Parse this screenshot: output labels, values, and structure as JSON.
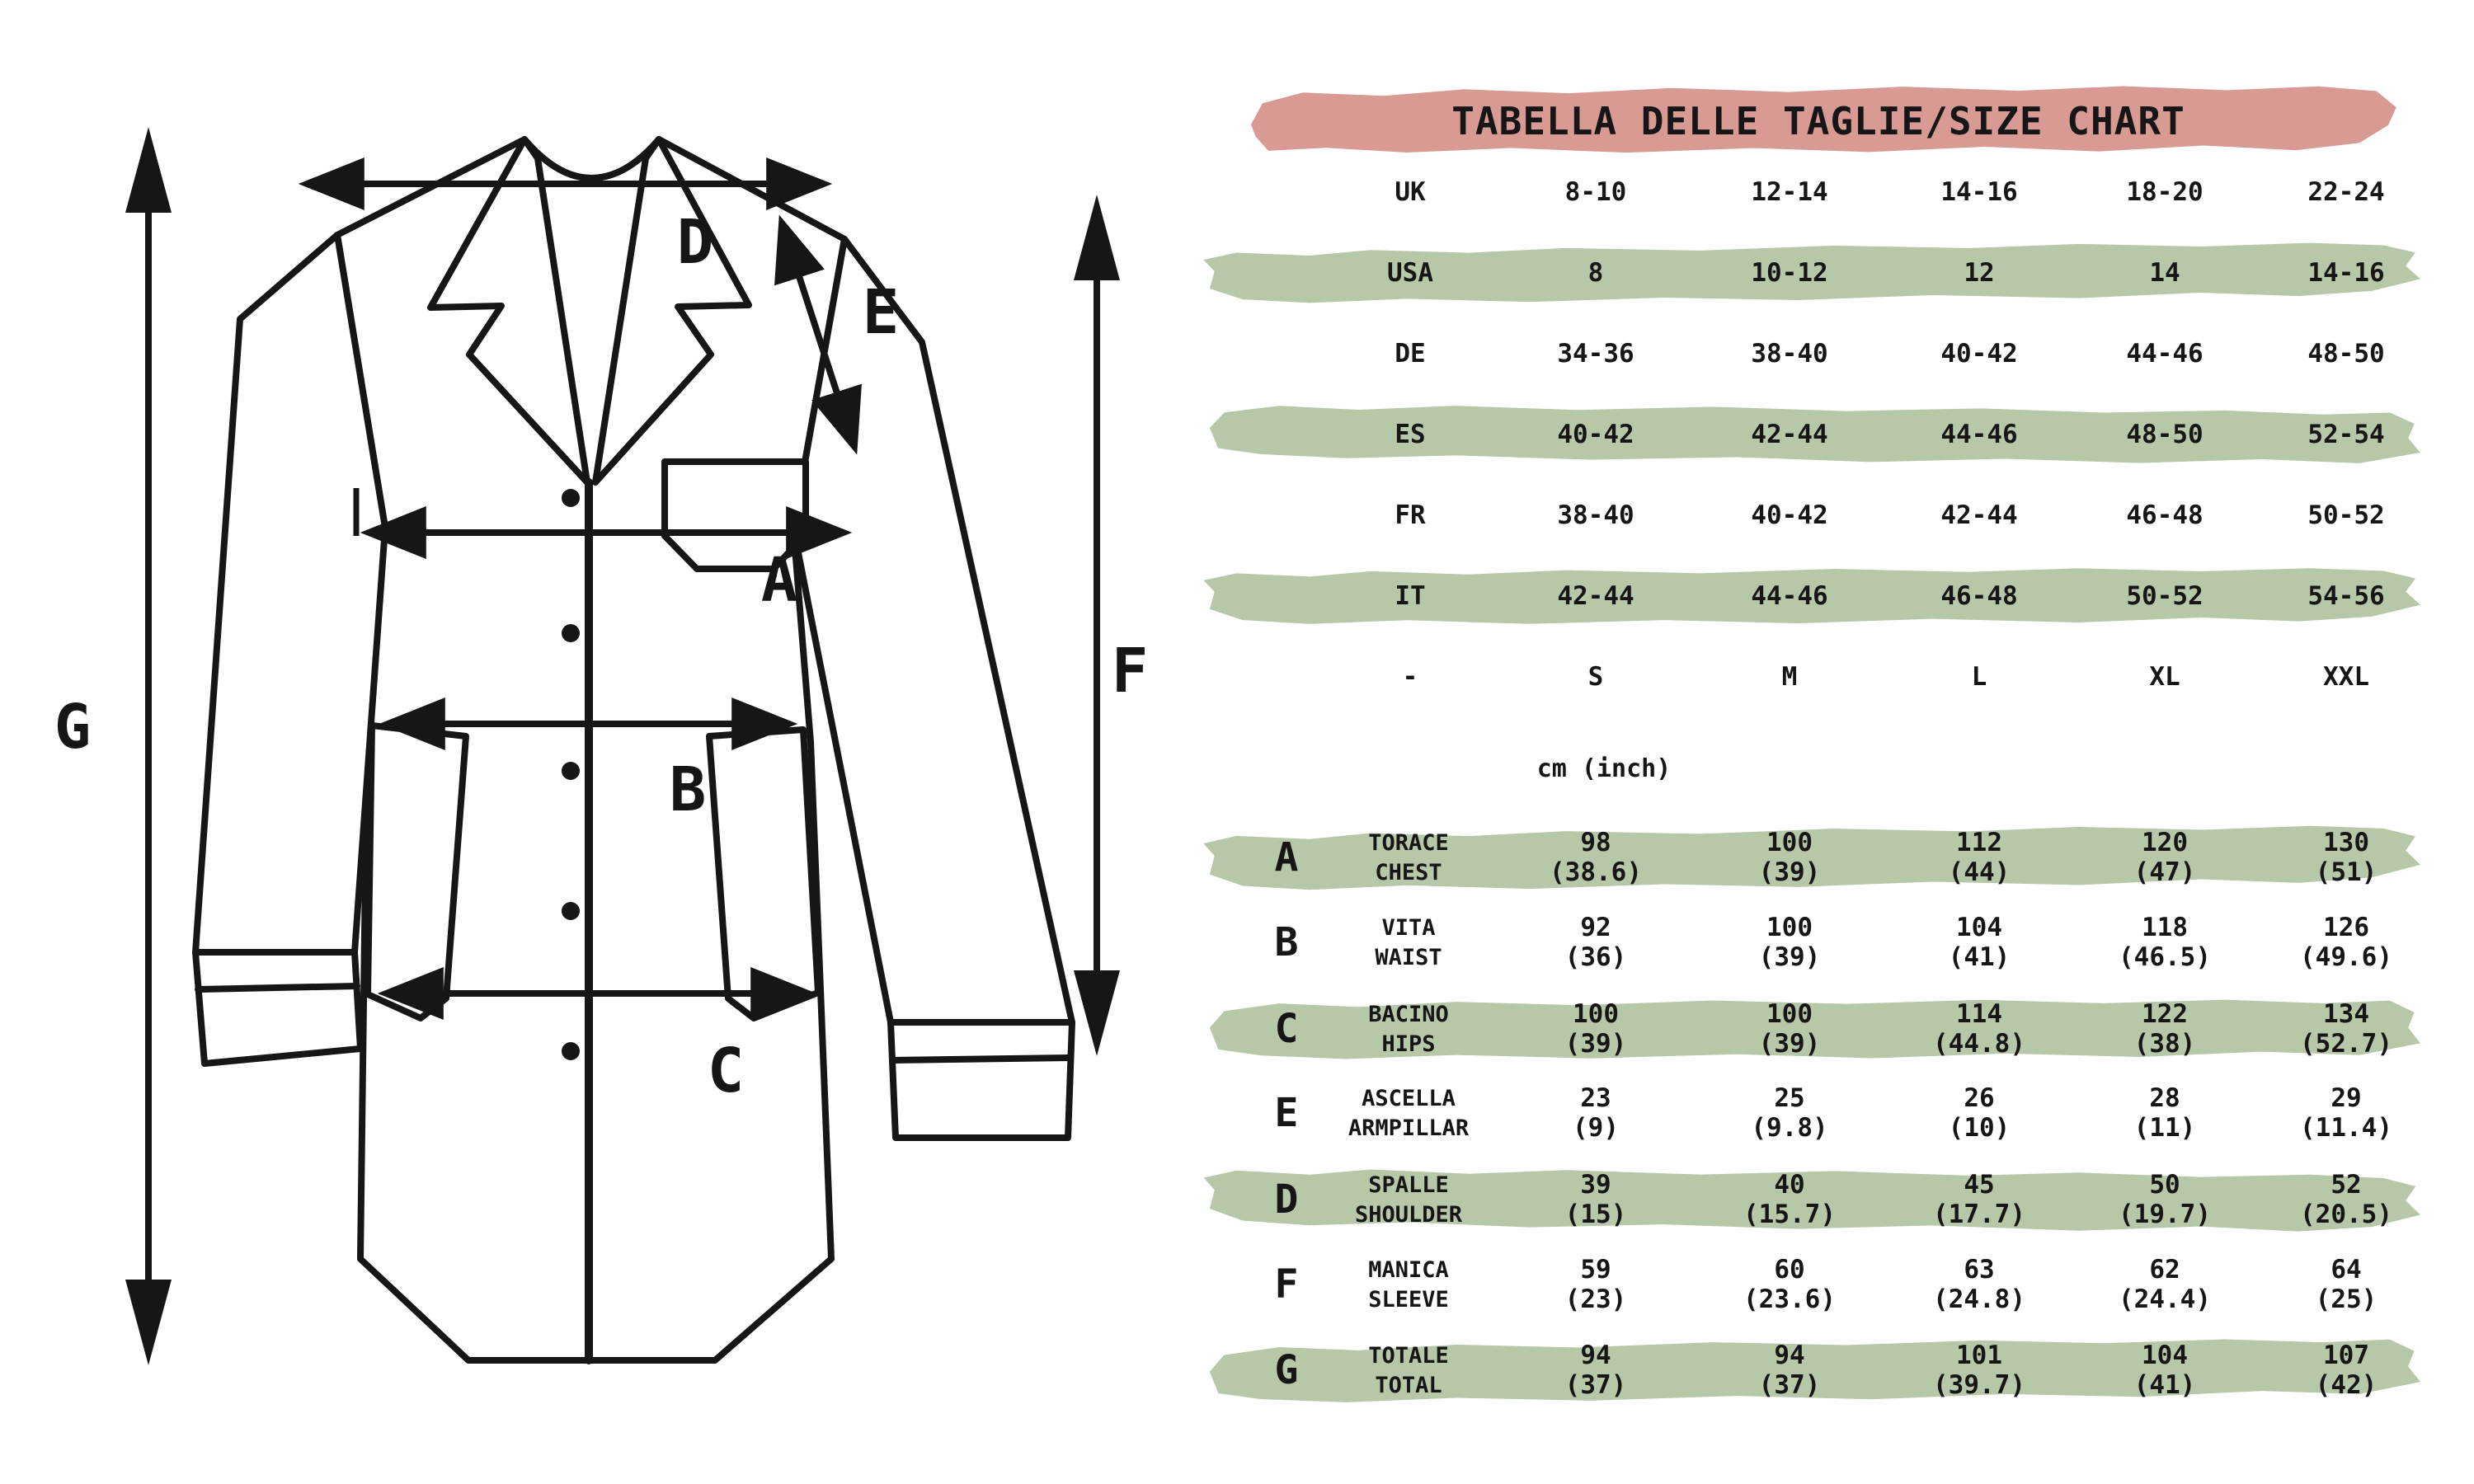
{
  "title": "TABELLA DELLE TAGLIE/SIZE CHART",
  "units_label": "cm (inch)",
  "size_table": {
    "rows": [
      {
        "label": "UK",
        "values": [
          "8-10",
          "12-14",
          "14-16",
          "18-20",
          "22-24"
        ],
        "striped": false
      },
      {
        "label": "USA",
        "values": [
          "8",
          "10-12",
          "12",
          "14",
          "14-16"
        ],
        "striped": true
      },
      {
        "label": "DE",
        "values": [
          "34-36",
          "38-40",
          "40-42",
          "44-46",
          "48-50"
        ],
        "striped": false
      },
      {
        "label": "ES",
        "values": [
          "40-42",
          "42-44",
          "44-46",
          "48-50",
          "52-54"
        ],
        "striped": true
      },
      {
        "label": "FR",
        "values": [
          "38-40",
          "40-42",
          "42-44",
          "46-48",
          "50-52"
        ],
        "striped": false
      },
      {
        "label": "IT",
        "values": [
          "42-44",
          "44-46",
          "46-48",
          "50-52",
          "54-56"
        ],
        "striped": true
      },
      {
        "label": "-",
        "values": [
          "S",
          "M",
          "L",
          "XL",
          "XXL"
        ],
        "striped": false
      }
    ]
  },
  "measure_table": {
    "rows": [
      {
        "letter": "A",
        "name_it": "TORACE",
        "name_en": "CHEST",
        "cm": [
          "98",
          "100",
          "112",
          "120",
          "130"
        ],
        "inch": [
          "(38.6)",
          "(39)",
          "(44)",
          "(47)",
          "(51)"
        ],
        "striped": true
      },
      {
        "letter": "B",
        "name_it": "VITA",
        "name_en": "WAIST",
        "cm": [
          "92",
          "100",
          "104",
          "118",
          "126"
        ],
        "inch": [
          "(36)",
          "(39)",
          "(41)",
          "(46.5)",
          "(49.6)"
        ],
        "striped": false
      },
      {
        "letter": "C",
        "name_it": "BACINO",
        "name_en": "HIPS",
        "cm": [
          "100",
          "100",
          "114",
          "122",
          "134"
        ],
        "inch": [
          "(39)",
          "(39)",
          "(44.8)",
          "(38)",
          "(52.7)"
        ],
        "striped": true
      },
      {
        "letter": "E",
        "name_it": "ASCELLA",
        "name_en": "ARMPILLAR",
        "cm": [
          "23",
          "25",
          "26",
          "28",
          "29"
        ],
        "inch": [
          "(9)",
          "(9.8)",
          "(10)",
          "(11)",
          "(11.4)"
        ],
        "striped": false
      },
      {
        "letter": "D",
        "name_it": "SPALLE",
        "name_en": "SHOULDER",
        "cm": [
          "39",
          "40",
          "45",
          "50",
          "52"
        ],
        "inch": [
          "(15)",
          "(15.7)",
          "(17.7)",
          "(19.7)",
          "(20.5)"
        ],
        "striped": true
      },
      {
        "letter": "F",
        "name_it": "MANICA",
        "name_en": "SLEEVE",
        "cm": [
          "59",
          "60",
          "63",
          "62",
          "64"
        ],
        "inch": [
          "(23)",
          "(23.6)",
          "(24.8)",
          "(24.4)",
          "(25)"
        ],
        "striped": false
      },
      {
        "letter": "G",
        "name_it": "TOTALE",
        "name_en": "TOTAL",
        "cm": [
          "94",
          "94",
          "101",
          "104",
          "107"
        ],
        "inch": [
          "(37)",
          "(37)",
          "(39.7)",
          "(41)",
          "(42)"
        ],
        "striped": true
      }
    ]
  },
  "diagram": {
    "labels": {
      "a": "A",
      "b": "B",
      "c": "C",
      "d": "D",
      "e": "E",
      "f": "F",
      "g": "G"
    }
  },
  "colors": {
    "pink": "#d89a93",
    "green": "#b6c8a8",
    "ink": "#161616"
  }
}
